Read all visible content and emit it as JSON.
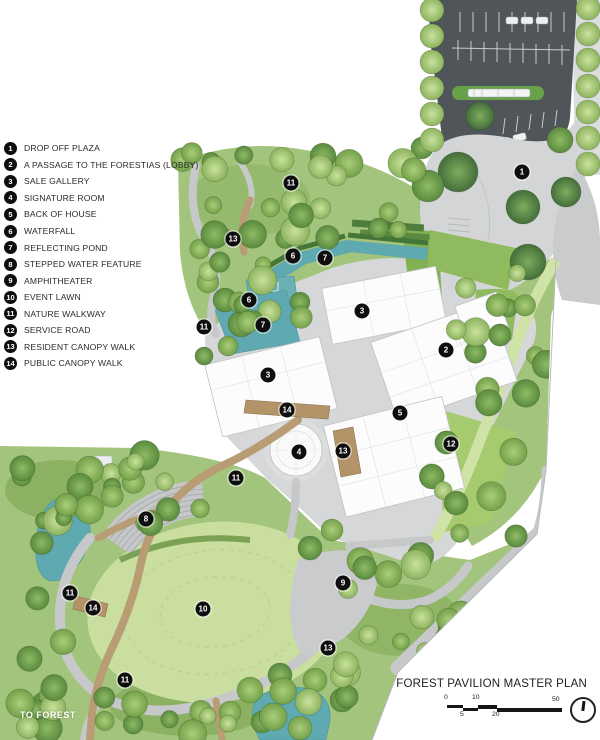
{
  "title_block": {
    "title": "FOREST PAVILION MASTER PLAN",
    "scale": {
      "top_labels": [
        "0",
        "10",
        "50"
      ],
      "bottom_labels": [
        "5",
        "20"
      ]
    }
  },
  "plan": {
    "to_forest_label": "TO FOREST",
    "markers": [
      {
        "n": "1"
      },
      {
        "n": "11"
      },
      {
        "n": "13"
      },
      {
        "n": "6"
      },
      {
        "n": "7"
      },
      {
        "n": "6"
      },
      {
        "n": "7"
      },
      {
        "n": "11"
      },
      {
        "n": "3"
      },
      {
        "n": "2"
      },
      {
        "n": "3"
      },
      {
        "n": "14"
      },
      {
        "n": "5"
      },
      {
        "n": "12"
      },
      {
        "n": "4"
      },
      {
        "n": "13"
      },
      {
        "n": "11"
      },
      {
        "n": "8"
      },
      {
        "n": "9"
      },
      {
        "n": "11"
      },
      {
        "n": "14"
      },
      {
        "n": "10"
      },
      {
        "n": "13"
      },
      {
        "n": "11"
      }
    ]
  },
  "legend": {
    "items": [
      {
        "num": "1",
        "label": "DROP OFF PLAZA"
      },
      {
        "num": "2",
        "label": "A PASSAGE TO THE FORESTIAS (LOBBY)"
      },
      {
        "num": "3",
        "label": "SALE GALLERY"
      },
      {
        "num": "4",
        "label": "SIGNATURE ROOM"
      },
      {
        "num": "5",
        "label": "BACK OF HOUSE"
      },
      {
        "num": "6",
        "label": "WATERFALL"
      },
      {
        "num": "7",
        "label": "REFLECTING POND"
      },
      {
        "num": "8",
        "label": "STEPPED WATER FEATURE"
      },
      {
        "num": "9",
        "label": "AMPHITHEATER"
      },
      {
        "num": "10",
        "label": "EVENT LAWN"
      },
      {
        "num": "11",
        "label": "NATURE WALKWAY"
      },
      {
        "num": "12",
        "label": "SERVICE ROAD"
      },
      {
        "num": "13",
        "label": "RESIDENT CANOPY WALK"
      },
      {
        "num": "14",
        "label": "PUBLIC CANOPY WALK"
      }
    ]
  },
  "colors": {
    "marker": "#0e0e0e",
    "water": "#5fa9b0",
    "event_lawn": "#cadf9f",
    "tree_light": "#a8cc77",
    "tree_dark": "#5a8a3e",
    "parking_asphalt": "#50555a",
    "path_gray": "#c6c8c9",
    "canopy_walk_tan": "#b89d74",
    "title_text": "#242021"
  }
}
